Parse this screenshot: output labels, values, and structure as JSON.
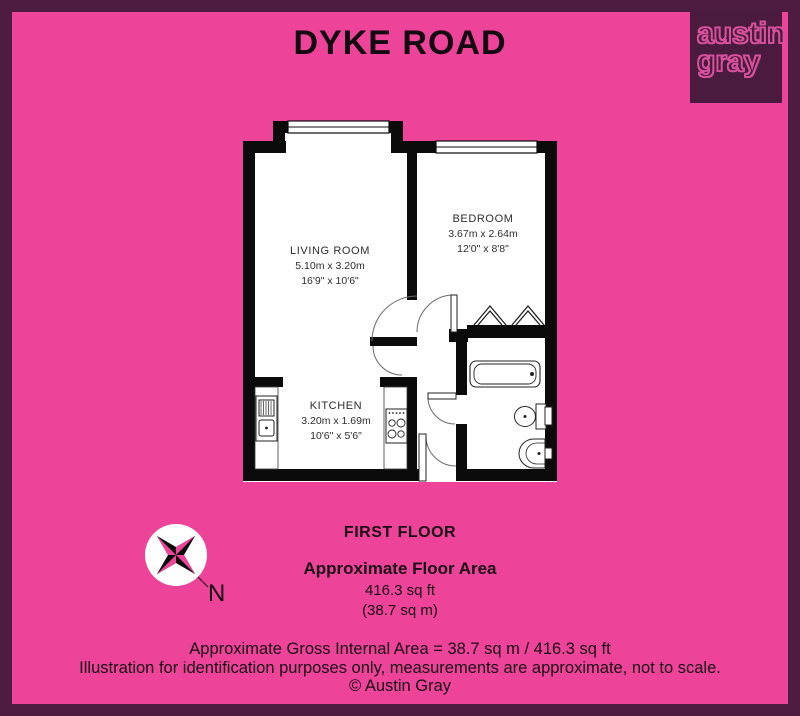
{
  "title": "DYKE ROAD",
  "logo": {
    "line1": "austin",
    "line2": "gray"
  },
  "floor_info": {
    "floor_label": "FIRST FLOOR",
    "area_heading": "Approximate Floor Area",
    "area_imperial": "416.3 sq ft",
    "area_metric": "(38.7 sq m)"
  },
  "compass": {
    "north_label": "N"
  },
  "rooms": {
    "living_room": {
      "name": "LIVING ROOM",
      "metric": "5.10m x 3.20m",
      "imperial": "16'9\" x 10'6\""
    },
    "bedroom": {
      "name": "BEDROOM",
      "metric": "3.67m x 2.64m",
      "imperial": "12'0\" x 8'8\""
    },
    "kitchen": {
      "name": "KITCHEN",
      "metric": "3.20m x 1.69m",
      "imperial": "10'6\" x 5'6\""
    }
  },
  "footer": {
    "line1": "Approximate Gross Internal Area = 38.7 sq m / 416.3 sq ft",
    "line2": "Illustration for identification purposes only, measurements are approximate, not to scale.",
    "line3": "© Austin Gray"
  },
  "colors": {
    "background_pink": "#ED4398",
    "border_purple": "#4F1C41",
    "logo_background": "#4A1B3F",
    "logo_text_pink": "#D8519C",
    "wall_black": "#0B0B0B"
  }
}
